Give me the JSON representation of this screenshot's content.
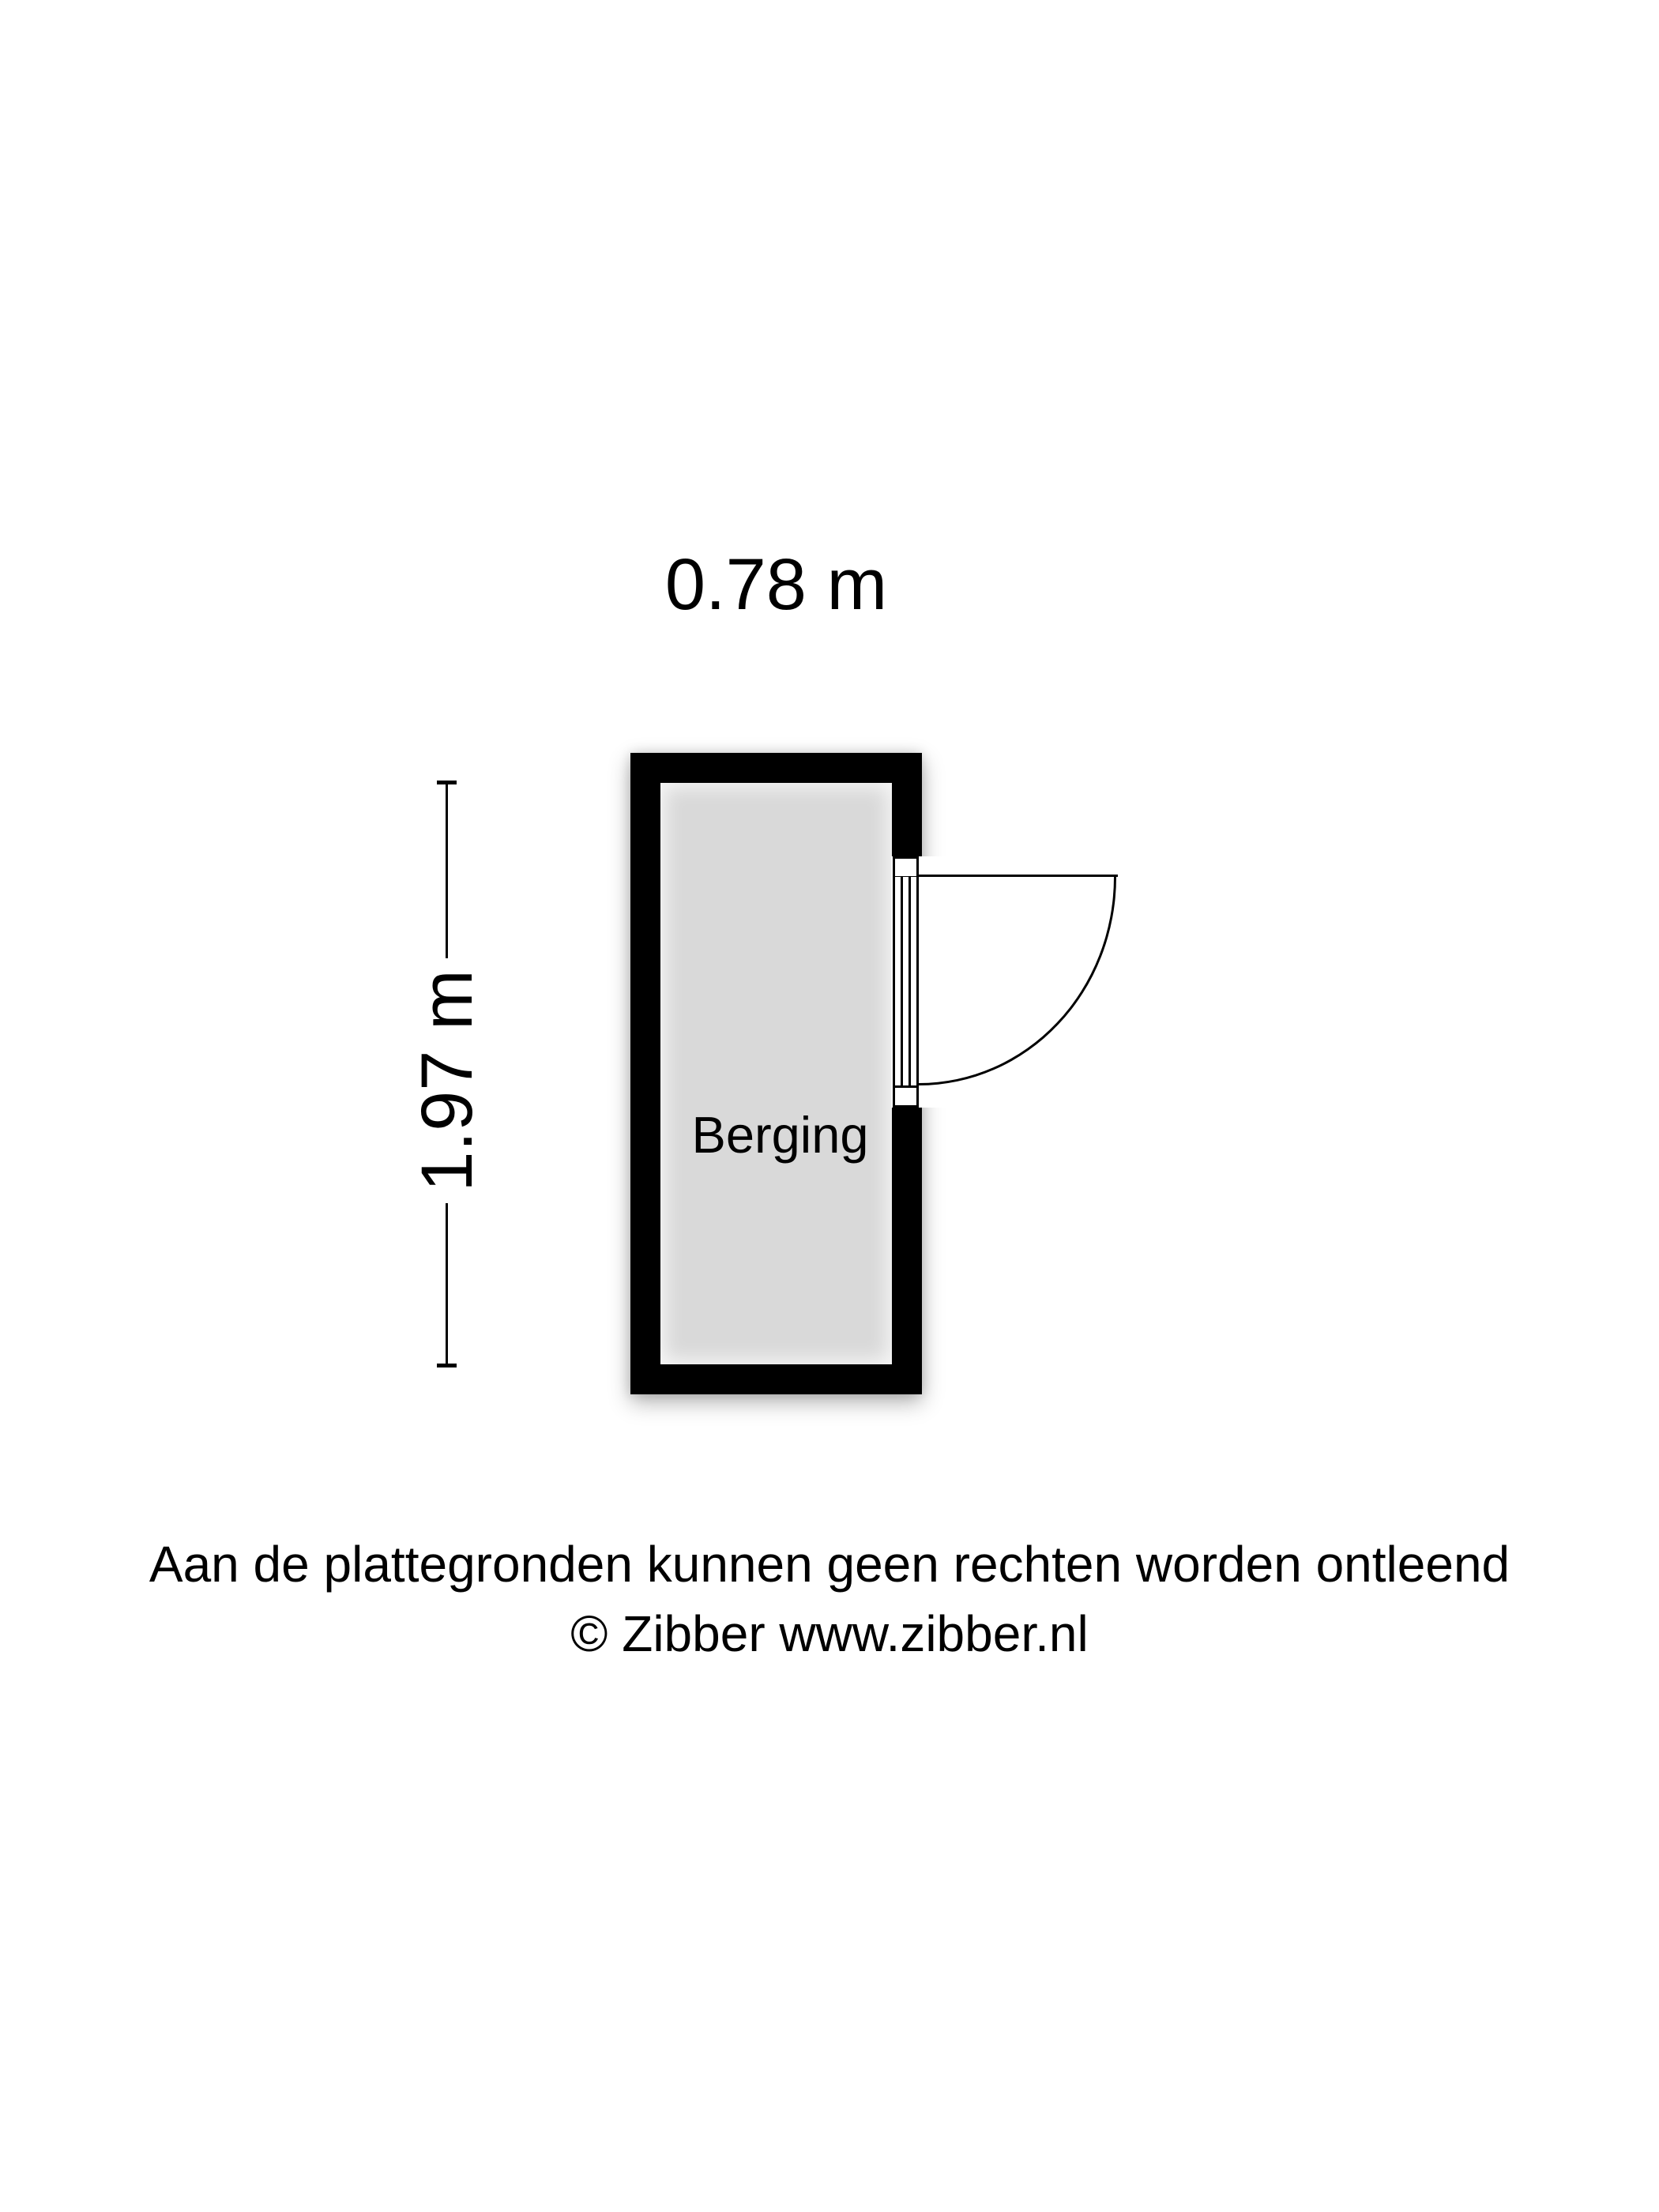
{
  "floorplan": {
    "width_label": "0.78 m",
    "height_label": "1.97 m",
    "room_label": "Berging"
  },
  "footer": {
    "disclaimer": "Aan de plattegronden kunnen geen rechten worden ontleend",
    "copyright": "© Zibber www.zibber.nl"
  },
  "colors": {
    "background": "#ffffff",
    "wall": "#000000",
    "floor": "#d9d9d9",
    "line": "#000000",
    "text": "#000000"
  }
}
